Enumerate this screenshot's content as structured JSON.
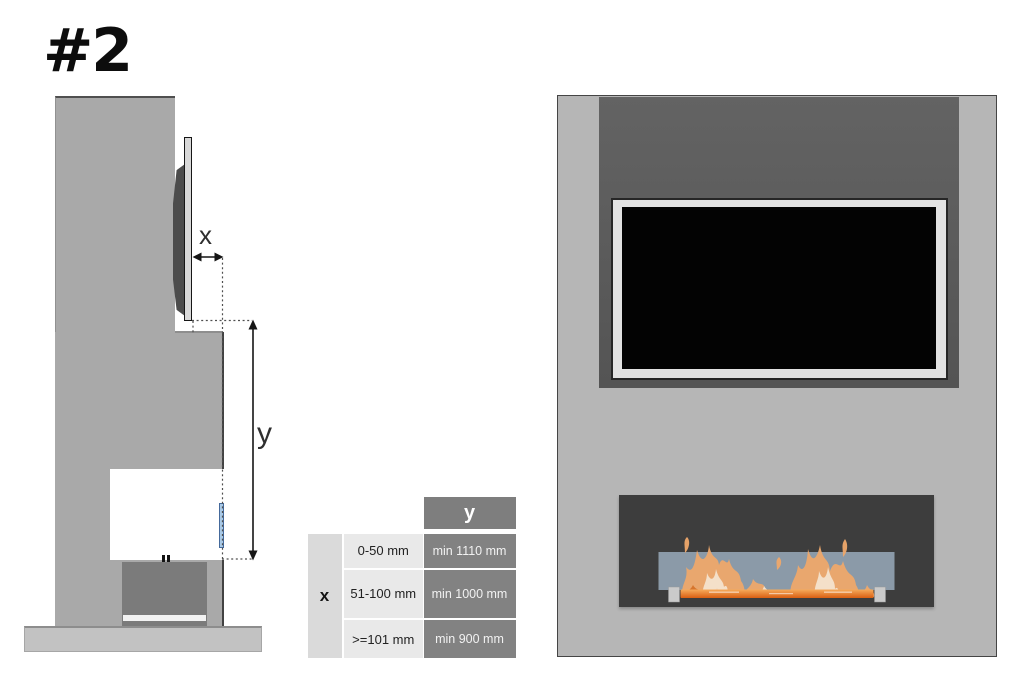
{
  "title": {
    "label": "#2"
  },
  "side_view": {
    "dim_x_label": "x",
    "dim_y_label": "y"
  },
  "clearance_table": {
    "col_header": "y",
    "row_header": "x",
    "rows": [
      {
        "x_range": "0-50 mm",
        "y_min": "min 1110 mm"
      },
      {
        "x_range": "51-100 mm",
        "y_min": "min 1000 mm"
      },
      {
        "x_range": ">=101 mm",
        "y_min": "min 900 mm"
      }
    ]
  },
  "colors": {
    "wall_gray": "#a9a9a9",
    "panel_gray": "#b6b6b6",
    "recess_dark": "#595959",
    "table_header_gray": "#7e7e7e",
    "table_value_gray": "#828282",
    "table_light_gray": "#e9e9e9",
    "front_glass_blue": "#91a1b0",
    "side_glass_blue": "#a9c9e6",
    "flame_orange": "#e2711c",
    "tv_screen_black": "#030303"
  }
}
